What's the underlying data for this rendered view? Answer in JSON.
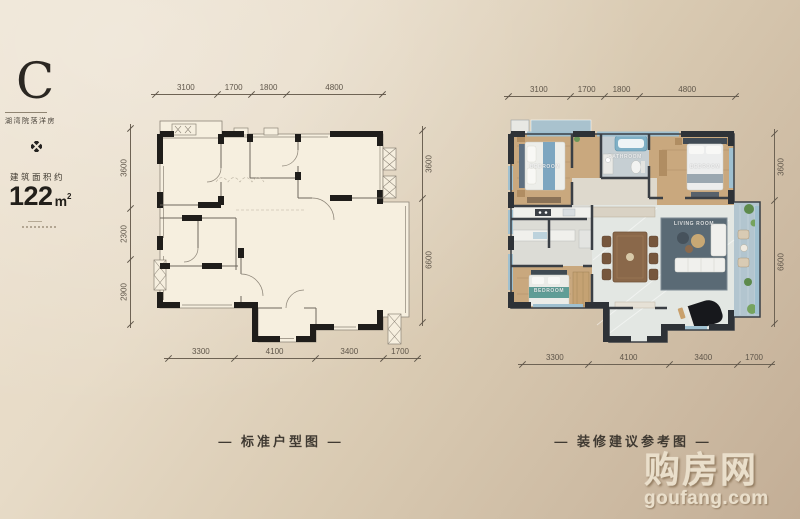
{
  "info_panel": {
    "type_letter": "C",
    "type_subtitle": "湖湾院落洋房",
    "area_label": "建筑面积约",
    "area_number": "122",
    "area_unit": "m",
    "area_exponent": "2"
  },
  "plans": {
    "standard": {
      "caption": "— 标准户型图 —",
      "dims": {
        "top": [
          "3100",
          "1700",
          "1800",
          "4800"
        ],
        "bottom": [
          "3300",
          "4100",
          "3400",
          "1700"
        ],
        "left": [
          "3600",
          "2300",
          "2900"
        ],
        "right": [
          "3600",
          "6600"
        ]
      }
    },
    "furnished": {
      "caption": "— 装修建议参考图 —",
      "dims": {
        "top": [
          "3100",
          "1700",
          "1800",
          "4800"
        ],
        "bottom": [
          "3300",
          "4100",
          "3400",
          "1700"
        ],
        "right": [
          "3600",
          "6600"
        ]
      },
      "room_labels": {
        "bedroom_tl": "BEDROOM",
        "bathroom": "BATHROOM",
        "bedroom_tr": "BEDROOM",
        "bedroom_bl": "BEDROOM",
        "living_room": "LIVING ROOM"
      }
    }
  },
  "watermark": {
    "brand": "购房网",
    "domain": "goufang.com"
  },
  "colors": {
    "background_light": "#ece1cf",
    "background_dark": "#c3ae96",
    "wall_black": "#1f1d1a",
    "wall_dark": "#2e3237",
    "wood_floor": "#c9a87e",
    "marble_floor": "#e3e7e3",
    "glass_blue": "#9fc0d0",
    "dim_text": "#5f564a"
  }
}
